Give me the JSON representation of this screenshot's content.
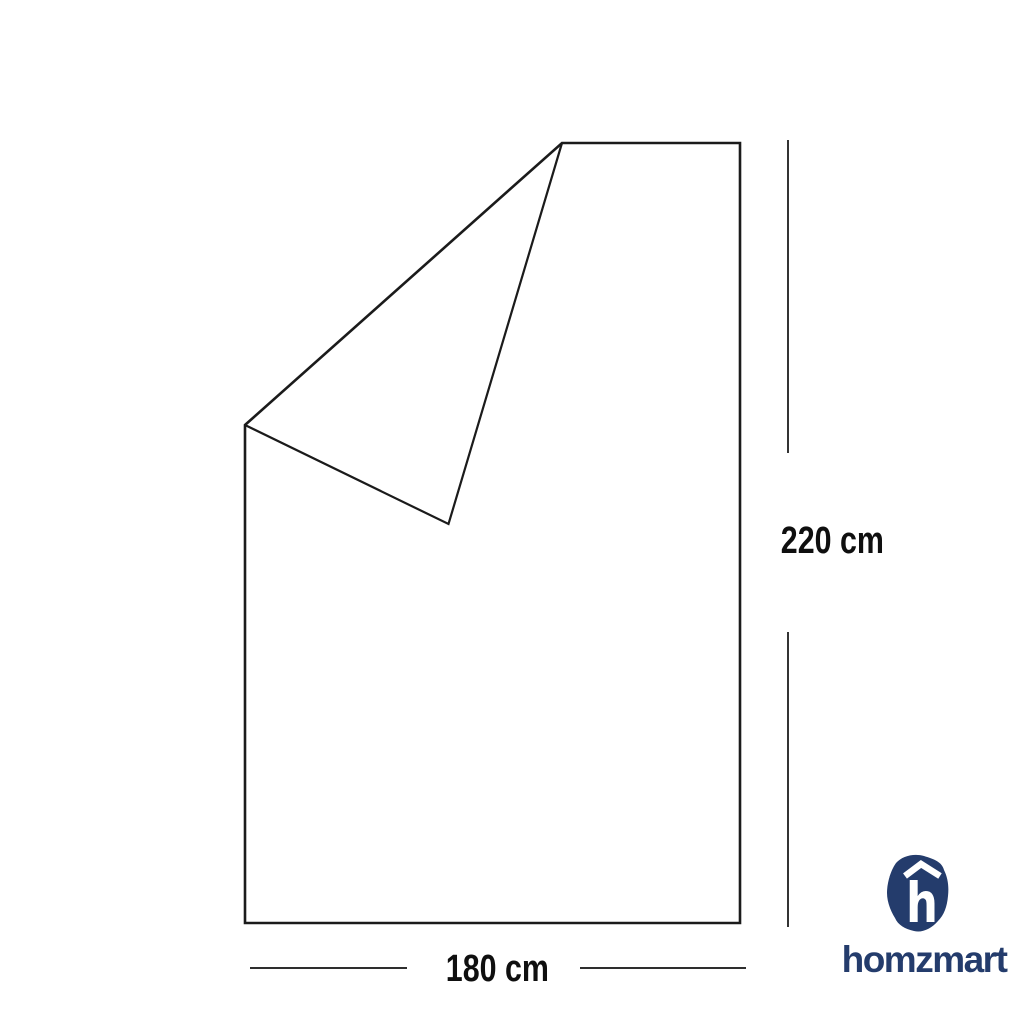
{
  "page": {
    "background_color": "#ffffff"
  },
  "diagram": {
    "subject": "blanket-with-folded-corner",
    "line_color": "#1b1b1b",
    "dimension_line_color": "#111111",
    "label_color": "#0f0f0f",
    "height": {
      "label": "220 cm",
      "value": 220,
      "unit": "cm"
    },
    "width": {
      "label": "180 cm",
      "value": 180,
      "unit": "cm"
    }
  },
  "brand": {
    "name": "homzmart",
    "logo_letter": "h",
    "logo_color": "#243c6c",
    "logo_glyph_color": "#ffffff"
  }
}
